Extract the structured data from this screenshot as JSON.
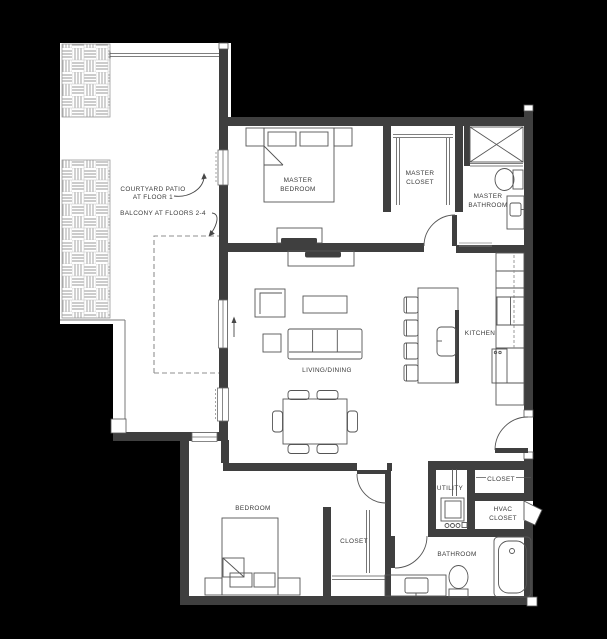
{
  "plan": {
    "labels": {
      "courtyard_patio": {
        "line1": "COURTYARD PATIO",
        "line2": "AT FLOOR 1"
      },
      "balcony": {
        "line1": "BALCONY AT FLOORS 2-4"
      },
      "master_bedroom": {
        "line1": "MASTER",
        "line2": "BEDROOM"
      },
      "master_closet": {
        "line1": "MASTER",
        "line2": "CLOSET"
      },
      "master_bathroom": {
        "line1": "MASTER",
        "line2": "BATHROOM"
      },
      "living_dining": {
        "line1": "LIVING/DINING"
      },
      "kitchen": {
        "line1": "KITCHEN"
      },
      "bedroom": {
        "line1": "BEDROOM"
      },
      "bedroom_closet": {
        "line1": "CLOSET"
      },
      "utility": {
        "line1": "UTILITY"
      },
      "entry_closet": {
        "line1": "CLOSET"
      },
      "hvac_closet": {
        "line1": "HVAC",
        "line2": "CLOSET"
      },
      "bathroom": {
        "line1": "BATHROOM"
      }
    },
    "colors": {
      "background": "#000000",
      "floor": "#ffffff",
      "wall": "#3f3f3f",
      "line": "#555555",
      "light_line": "#8f8f8f",
      "hatch_line": "#9a9a9a",
      "text": "#3a3a3a"
    }
  }
}
